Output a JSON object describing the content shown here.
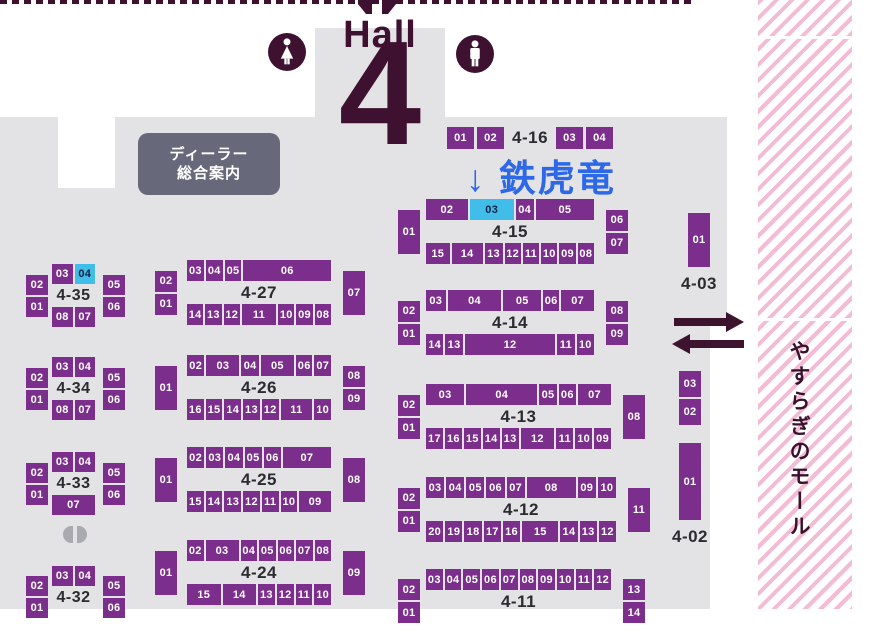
{
  "header": {
    "hall_word": "Hall",
    "hall_number": "4"
  },
  "annotation": {
    "text": "↓ 鉄虎竜"
  },
  "dealer_info": {
    "line1": "ディーラー",
    "line2": "総合案内"
  },
  "mall": {
    "label": "やすらぎのモール"
  },
  "colors": {
    "booth_purple": "#7c2e8c",
    "highlight_cyan": "#41bde9",
    "floor_gray": "#e3e2e4",
    "accent_dark_maroon": "#3f1130",
    "annotation_blue": "#2c68e8",
    "stripe_pink": "#f3bcd4",
    "dealer_box_gray": "#67687a"
  },
  "icons": [
    "female-restroom-icon",
    "male-restroom-icon",
    "arrow-right-icon",
    "arrow-left-icon",
    "pillar-icon",
    "partial-top-icon"
  ],
  "blocks": [
    {
      "id": "4-16",
      "type": "row",
      "cls": "c",
      "label": "4-16",
      "cells_before": [
        {
          "t": "01"
        },
        {
          "t": "02"
        }
      ],
      "cells_after": [
        {
          "t": "03"
        },
        {
          "t": "04"
        }
      ]
    },
    {
      "id": "4-15",
      "type": "std",
      "cls": "c",
      "label": "4-15",
      "left": [
        {
          "t": "01",
          "h": 44
        }
      ],
      "top": [
        {
          "t": "02",
          "w": 2.3
        },
        {
          "t": "03",
          "w": 2.4,
          "hl": true
        },
        {
          "t": "04",
          "w": 1
        },
        {
          "t": "05",
          "w": 3.2
        }
      ],
      "bottom": [
        {
          "t": "15",
          "w": 1.45
        },
        {
          "t": "14",
          "w": 1.9
        },
        {
          "t": "13",
          "w": 1.1
        },
        {
          "t": "12"
        },
        {
          "t": "11"
        },
        {
          "t": "10"
        },
        {
          "t": "09"
        },
        {
          "t": "08"
        }
      ],
      "right": [
        {
          "t": "06"
        },
        {
          "t": "07"
        }
      ]
    },
    {
      "id": "4-14",
      "type": "std",
      "cls": "c",
      "label": "4-14",
      "left": [
        {
          "t": "02"
        },
        {
          "t": "01"
        }
      ],
      "top": [
        {
          "t": "03",
          "w": 1.2
        },
        {
          "t": "04",
          "w": 3.3
        },
        {
          "t": "05",
          "w": 2.3
        },
        {
          "t": "06"
        },
        {
          "t": "07",
          "w": 2
        }
      ],
      "bottom": [
        {
          "t": "14"
        },
        {
          "t": "13"
        },
        {
          "t": "12",
          "w": 5.2
        },
        {
          "t": "11"
        },
        {
          "t": "10"
        }
      ],
      "right": [
        {
          "t": "08"
        },
        {
          "t": "09"
        }
      ]
    },
    {
      "id": "4-13",
      "type": "std",
      "cls": "c",
      "label": "4-13",
      "left": [
        {
          "t": "02"
        },
        {
          "t": "01"
        }
      ],
      "top": [
        {
          "t": "03",
          "w": 2.2
        },
        {
          "t": "04",
          "w": 4.1
        },
        {
          "t": "05"
        },
        {
          "t": "06"
        },
        {
          "t": "07",
          "w": 1.9
        }
      ],
      "bottom": [
        {
          "t": "17"
        },
        {
          "t": "16"
        },
        {
          "t": "15"
        },
        {
          "t": "14"
        },
        {
          "t": "13"
        },
        {
          "t": "12",
          "w": 2
        },
        {
          "t": "11"
        },
        {
          "t": "10"
        },
        {
          "t": "09"
        }
      ],
      "right": [
        {
          "t": "08",
          "h": 44
        }
      ]
    },
    {
      "id": "4-12",
      "type": "std",
      "cls": "c",
      "label": "4-12",
      "left": [
        {
          "t": "02"
        },
        {
          "t": "01"
        }
      ],
      "top": [
        {
          "t": "03"
        },
        {
          "t": "04"
        },
        {
          "t": "05"
        },
        {
          "t": "06"
        },
        {
          "t": "07"
        },
        {
          "t": "08",
          "w": 2.7
        },
        {
          "t": "09"
        },
        {
          "t": "10"
        }
      ],
      "bottom": [
        {
          "t": "20"
        },
        {
          "t": "19"
        },
        {
          "t": "18"
        },
        {
          "t": "17"
        },
        {
          "t": "16"
        },
        {
          "t": "15",
          "w": 2.1
        },
        {
          "t": "14"
        },
        {
          "t": "13"
        },
        {
          "t": "12"
        }
      ],
      "right": [
        {
          "t": "11",
          "h": 44
        }
      ]
    },
    {
      "id": "4-11",
      "type": "std",
      "cls": "c",
      "label": "4-11",
      "left": [
        {
          "t": "02"
        },
        {
          "t": "01"
        }
      ],
      "top": [
        {
          "t": "03"
        },
        {
          "t": "04"
        },
        {
          "t": "05"
        },
        {
          "t": "06"
        },
        {
          "t": "07"
        },
        {
          "t": "08"
        },
        {
          "t": "09"
        },
        {
          "t": "10"
        },
        {
          "t": "11"
        },
        {
          "t": "12"
        }
      ],
      "right": [
        {
          "t": "13"
        },
        {
          "t": "14"
        }
      ]
    },
    {
      "id": "4-35",
      "type": "std",
      "cls": "s",
      "label": "4-35",
      "left": [
        {
          "t": "02"
        },
        {
          "t": "01"
        }
      ],
      "top": [
        {
          "t": "03"
        },
        {
          "t": "04",
          "hl": true
        }
      ],
      "bottom": [
        {
          "t": "08"
        },
        {
          "t": "07"
        }
      ],
      "right": [
        {
          "t": "05"
        },
        {
          "t": "06"
        }
      ]
    },
    {
      "id": "4-34",
      "type": "std",
      "cls": "s",
      "label": "4-34",
      "left": [
        {
          "t": "02"
        },
        {
          "t": "01"
        }
      ],
      "top": [
        {
          "t": "03"
        },
        {
          "t": "04"
        }
      ],
      "bottom": [
        {
          "t": "08"
        },
        {
          "t": "07"
        }
      ],
      "right": [
        {
          "t": "05"
        },
        {
          "t": "06"
        }
      ]
    },
    {
      "id": "4-33",
      "type": "std",
      "cls": "s",
      "label": "4-33",
      "left": [
        {
          "t": "02"
        },
        {
          "t": "01"
        }
      ],
      "top": [
        {
          "t": "03"
        },
        {
          "t": "04"
        }
      ],
      "bottom": [
        {
          "t": "07"
        }
      ],
      "right": [
        {
          "t": "05"
        },
        {
          "t": "06"
        }
      ]
    },
    {
      "id": "4-32",
      "type": "std",
      "cls": "s",
      "label": "4-32",
      "left": [
        {
          "t": "02"
        },
        {
          "t": "01"
        }
      ],
      "top": [
        {
          "t": "03"
        },
        {
          "t": "04"
        }
      ],
      "right": [
        {
          "t": "05"
        },
        {
          "t": "06"
        }
      ]
    },
    {
      "id": "4-27",
      "type": "std",
      "cls": "m",
      "label": "4-27",
      "left": [
        {
          "t": "02"
        },
        {
          "t": "01"
        }
      ],
      "top": [
        {
          "t": "03"
        },
        {
          "t": "04"
        },
        {
          "t": "05"
        },
        {
          "t": "06",
          "w": 5.2
        }
      ],
      "bottom": [
        {
          "t": "14"
        },
        {
          "t": "13"
        },
        {
          "t": "12"
        },
        {
          "t": "11",
          "w": 2.1
        },
        {
          "t": "10"
        },
        {
          "t": "09"
        },
        {
          "t": "08"
        }
      ],
      "right": [
        {
          "t": "07",
          "h": 44
        }
      ]
    },
    {
      "id": "4-26",
      "type": "std",
      "cls": "m",
      "label": "4-26",
      "left": [
        {
          "t": "01",
          "h": 44
        }
      ],
      "top": [
        {
          "t": "02"
        },
        {
          "t": "03",
          "w": 1.9
        },
        {
          "t": "04"
        },
        {
          "t": "05",
          "w": 1.9
        },
        {
          "t": "06",
          "w": 0.95
        },
        {
          "t": "07",
          "w": 0.95
        }
      ],
      "bottom": [
        {
          "t": "16"
        },
        {
          "t": "15"
        },
        {
          "t": "14"
        },
        {
          "t": "13"
        },
        {
          "t": "12"
        },
        {
          "t": "11",
          "w": 1.9
        },
        {
          "t": "10"
        }
      ],
      "right": [
        {
          "t": "08"
        },
        {
          "t": "09"
        }
      ]
    },
    {
      "id": "4-25",
      "type": "std",
      "cls": "m",
      "label": "4-25",
      "left": [
        {
          "t": "01",
          "h": 44
        }
      ],
      "top": [
        {
          "t": "02"
        },
        {
          "t": "03"
        },
        {
          "t": "04"
        },
        {
          "t": "05"
        },
        {
          "t": "06"
        },
        {
          "t": "07",
          "w": 2.8
        }
      ],
      "bottom": [
        {
          "t": "15"
        },
        {
          "t": "14"
        },
        {
          "t": "13"
        },
        {
          "t": "12"
        },
        {
          "t": "11"
        },
        {
          "t": "10"
        },
        {
          "t": "09",
          "w": 1.9
        }
      ],
      "right": [
        {
          "t": "08",
          "h": 44
        }
      ]
    },
    {
      "id": "4-24",
      "type": "std",
      "cls": "m",
      "label": "4-24",
      "left": [
        {
          "t": "01",
          "h": 44
        }
      ],
      "top": [
        {
          "t": "02"
        },
        {
          "t": "03",
          "w": 2
        },
        {
          "t": "04"
        },
        {
          "t": "05"
        },
        {
          "t": "06"
        },
        {
          "t": "07"
        },
        {
          "t": "08"
        }
      ],
      "bottom": [
        {
          "t": "15",
          "w": 2
        },
        {
          "t": "14",
          "w": 2
        },
        {
          "t": "13"
        },
        {
          "t": "12"
        },
        {
          "t": "11"
        },
        {
          "t": "10"
        }
      ],
      "right": [
        {
          "t": "09",
          "h": 44
        }
      ]
    },
    {
      "id": "4-03",
      "type": "vcol",
      "label": "4-03",
      "cells": [
        {
          "t": "01",
          "h": 54
        }
      ]
    },
    {
      "id": "4-02",
      "type": "vcol",
      "label": "4-02",
      "cells": [
        {
          "t": "03"
        },
        {
          "t": "02"
        },
        {
          "t": "01",
          "h": 77,
          "gap": 16
        }
      ]
    }
  ]
}
